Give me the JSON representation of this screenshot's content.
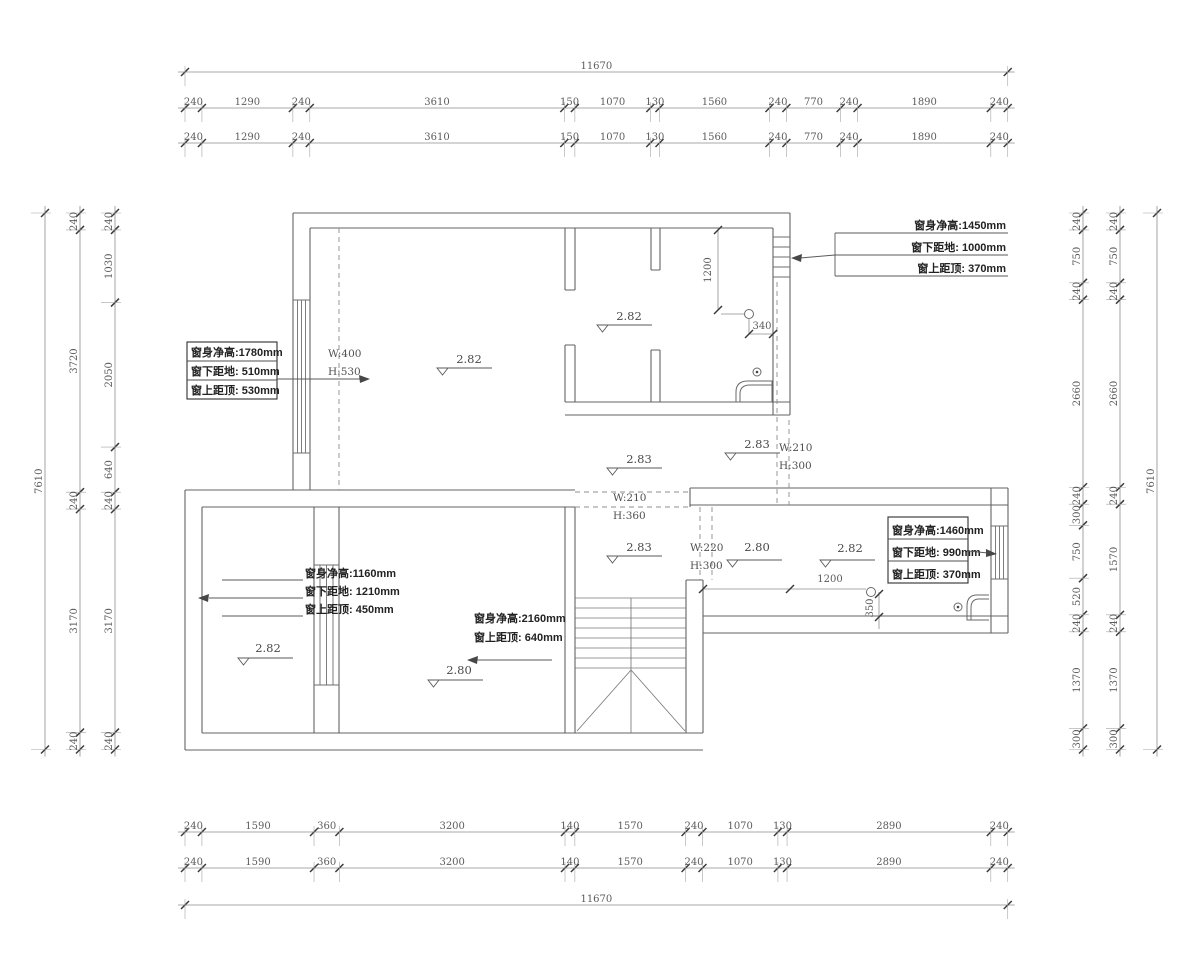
{
  "drawing": {
    "overall_width_mm": "11670",
    "overall_height_mm": "7610"
  },
  "dim_values": {
    "top_overall": [
      "11670"
    ],
    "top_row1": [
      "240",
      "1290",
      "240",
      "3610",
      "150",
      "1070",
      "130",
      "1560",
      "240",
      "770",
      "240",
      "1890",
      "240"
    ],
    "top_row2": [
      "240",
      "1290",
      "240",
      "3610",
      "150",
      "1070",
      "130",
      "1560",
      "240",
      "770",
      "240",
      "1890",
      "240"
    ],
    "bottom_row1": [
      "240",
      "1590",
      "360",
      "3200",
      "140",
      "1570",
      "240",
      "1070",
      "130",
      "2890",
      "240"
    ],
    "bottom_row2": [
      "240",
      "1590",
      "360",
      "3200",
      "140",
      "1570",
      "240",
      "1070",
      "130",
      "2890",
      "240"
    ],
    "bottom_overall": [
      "11670"
    ],
    "left_overall": [
      "7610"
    ],
    "left_mid": [
      "240",
      "3720",
      "240",
      "3170",
      "240"
    ],
    "left_inner": [
      "240",
      "1030",
      "2050",
      "640",
      "240",
      "3170",
      "240"
    ],
    "right_inner": [
      "240",
      "750",
      "240",
      "2660",
      "240",
      "300",
      "750",
      "520",
      "240",
      "1370",
      "300"
    ],
    "right_mid": [
      "240",
      "750",
      "240",
      "2660",
      "240",
      "1570",
      "240",
      "1370",
      "300"
    ],
    "right_overall": [
      "7610"
    ]
  },
  "window_notes": {
    "left_upper": {
      "l1": "窗身净高:1780mm",
      "l2": "窗下距地: 510mm",
      "l3": "窗上距顶: 530mm"
    },
    "top_right": {
      "l1": "窗身净高:1450mm",
      "l2": "窗下距地: 1000mm",
      "l3": "窗上距顶: 370mm"
    },
    "right_lower": {
      "l1": "窗身净高:1460mm",
      "l2": "窗下距地: 990mm",
      "l3": "窗上距顶: 370mm"
    },
    "lower_left": {
      "l1": "窗身净高:1160mm",
      "l2": "窗下距地: 1210mm",
      "l3": "窗上距顶: 450mm"
    },
    "stair": {
      "l1": "窗身净高:2160mm",
      "l2": "窗上距顶: 640mm"
    }
  },
  "beam_notes": {
    "upper_left": {
      "w": "W:400",
      "h": "H:530"
    },
    "mid_right": {
      "w": "W:210",
      "h": "H:300"
    },
    "mid_center": {
      "w": "W:210",
      "h": "H:360"
    },
    "lower_door": {
      "w": "W:220",
      "h": "H:300"
    }
  },
  "levels": [
    "2.82",
    "2.82",
    "2.83",
    "2.83",
    "2.83",
    "2.80",
    "2.82",
    "2.82",
    "2.80"
  ],
  "inline_dims": {
    "v1200": "1200",
    "d340": "340",
    "h1200": "1200",
    "d350": "350"
  }
}
